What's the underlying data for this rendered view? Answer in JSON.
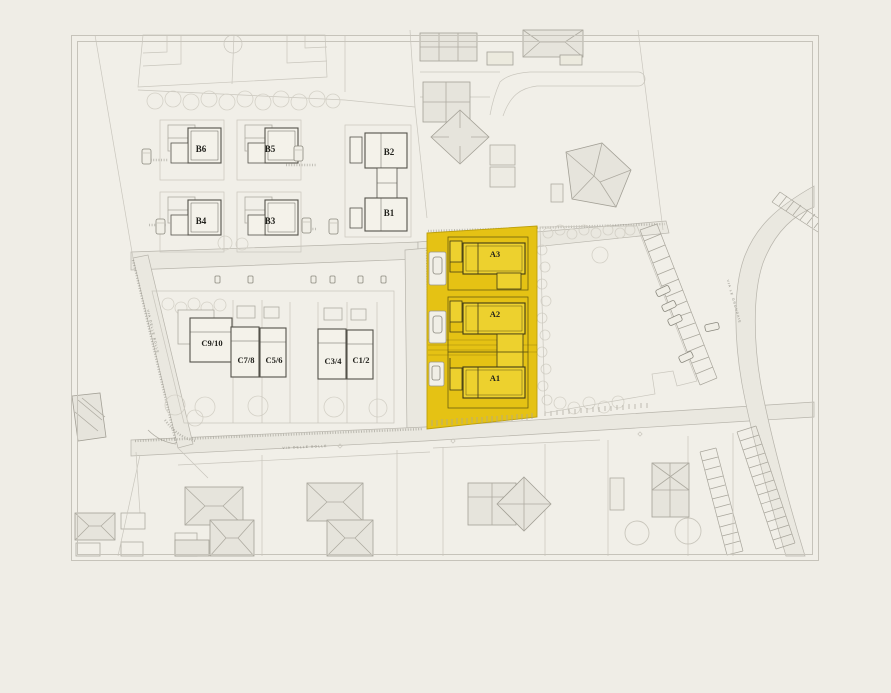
{
  "window": {
    "background": "#efede6"
  },
  "colors": {
    "bg": "#efede6",
    "paper": "#f1efe8",
    "frame": "#c6c3ba",
    "highlight": "#e5c214",
    "highlight-building": "#edd12e",
    "ink": "#21211c"
  },
  "plan": {
    "highlighted_zone": "A",
    "streets": {
      "bottom": "VIA DELLE BOLLE",
      "left": "VIA DELLE BOLLE",
      "right": "VIA LE GRONDAIE"
    },
    "units": {
      "b": [
        {
          "label": "B6"
        },
        {
          "label": "B5"
        },
        {
          "label": "B2"
        },
        {
          "label": "B4"
        },
        {
          "label": "B3"
        },
        {
          "label": "B1"
        }
      ],
      "c": [
        {
          "label": "C9/10"
        },
        {
          "label": "C7/8"
        },
        {
          "label": "C5/6"
        },
        {
          "label": "C3/4"
        },
        {
          "label": "C1/2"
        }
      ],
      "a": [
        {
          "label": "A3"
        },
        {
          "label": "A2"
        },
        {
          "label": "A1"
        }
      ]
    }
  }
}
